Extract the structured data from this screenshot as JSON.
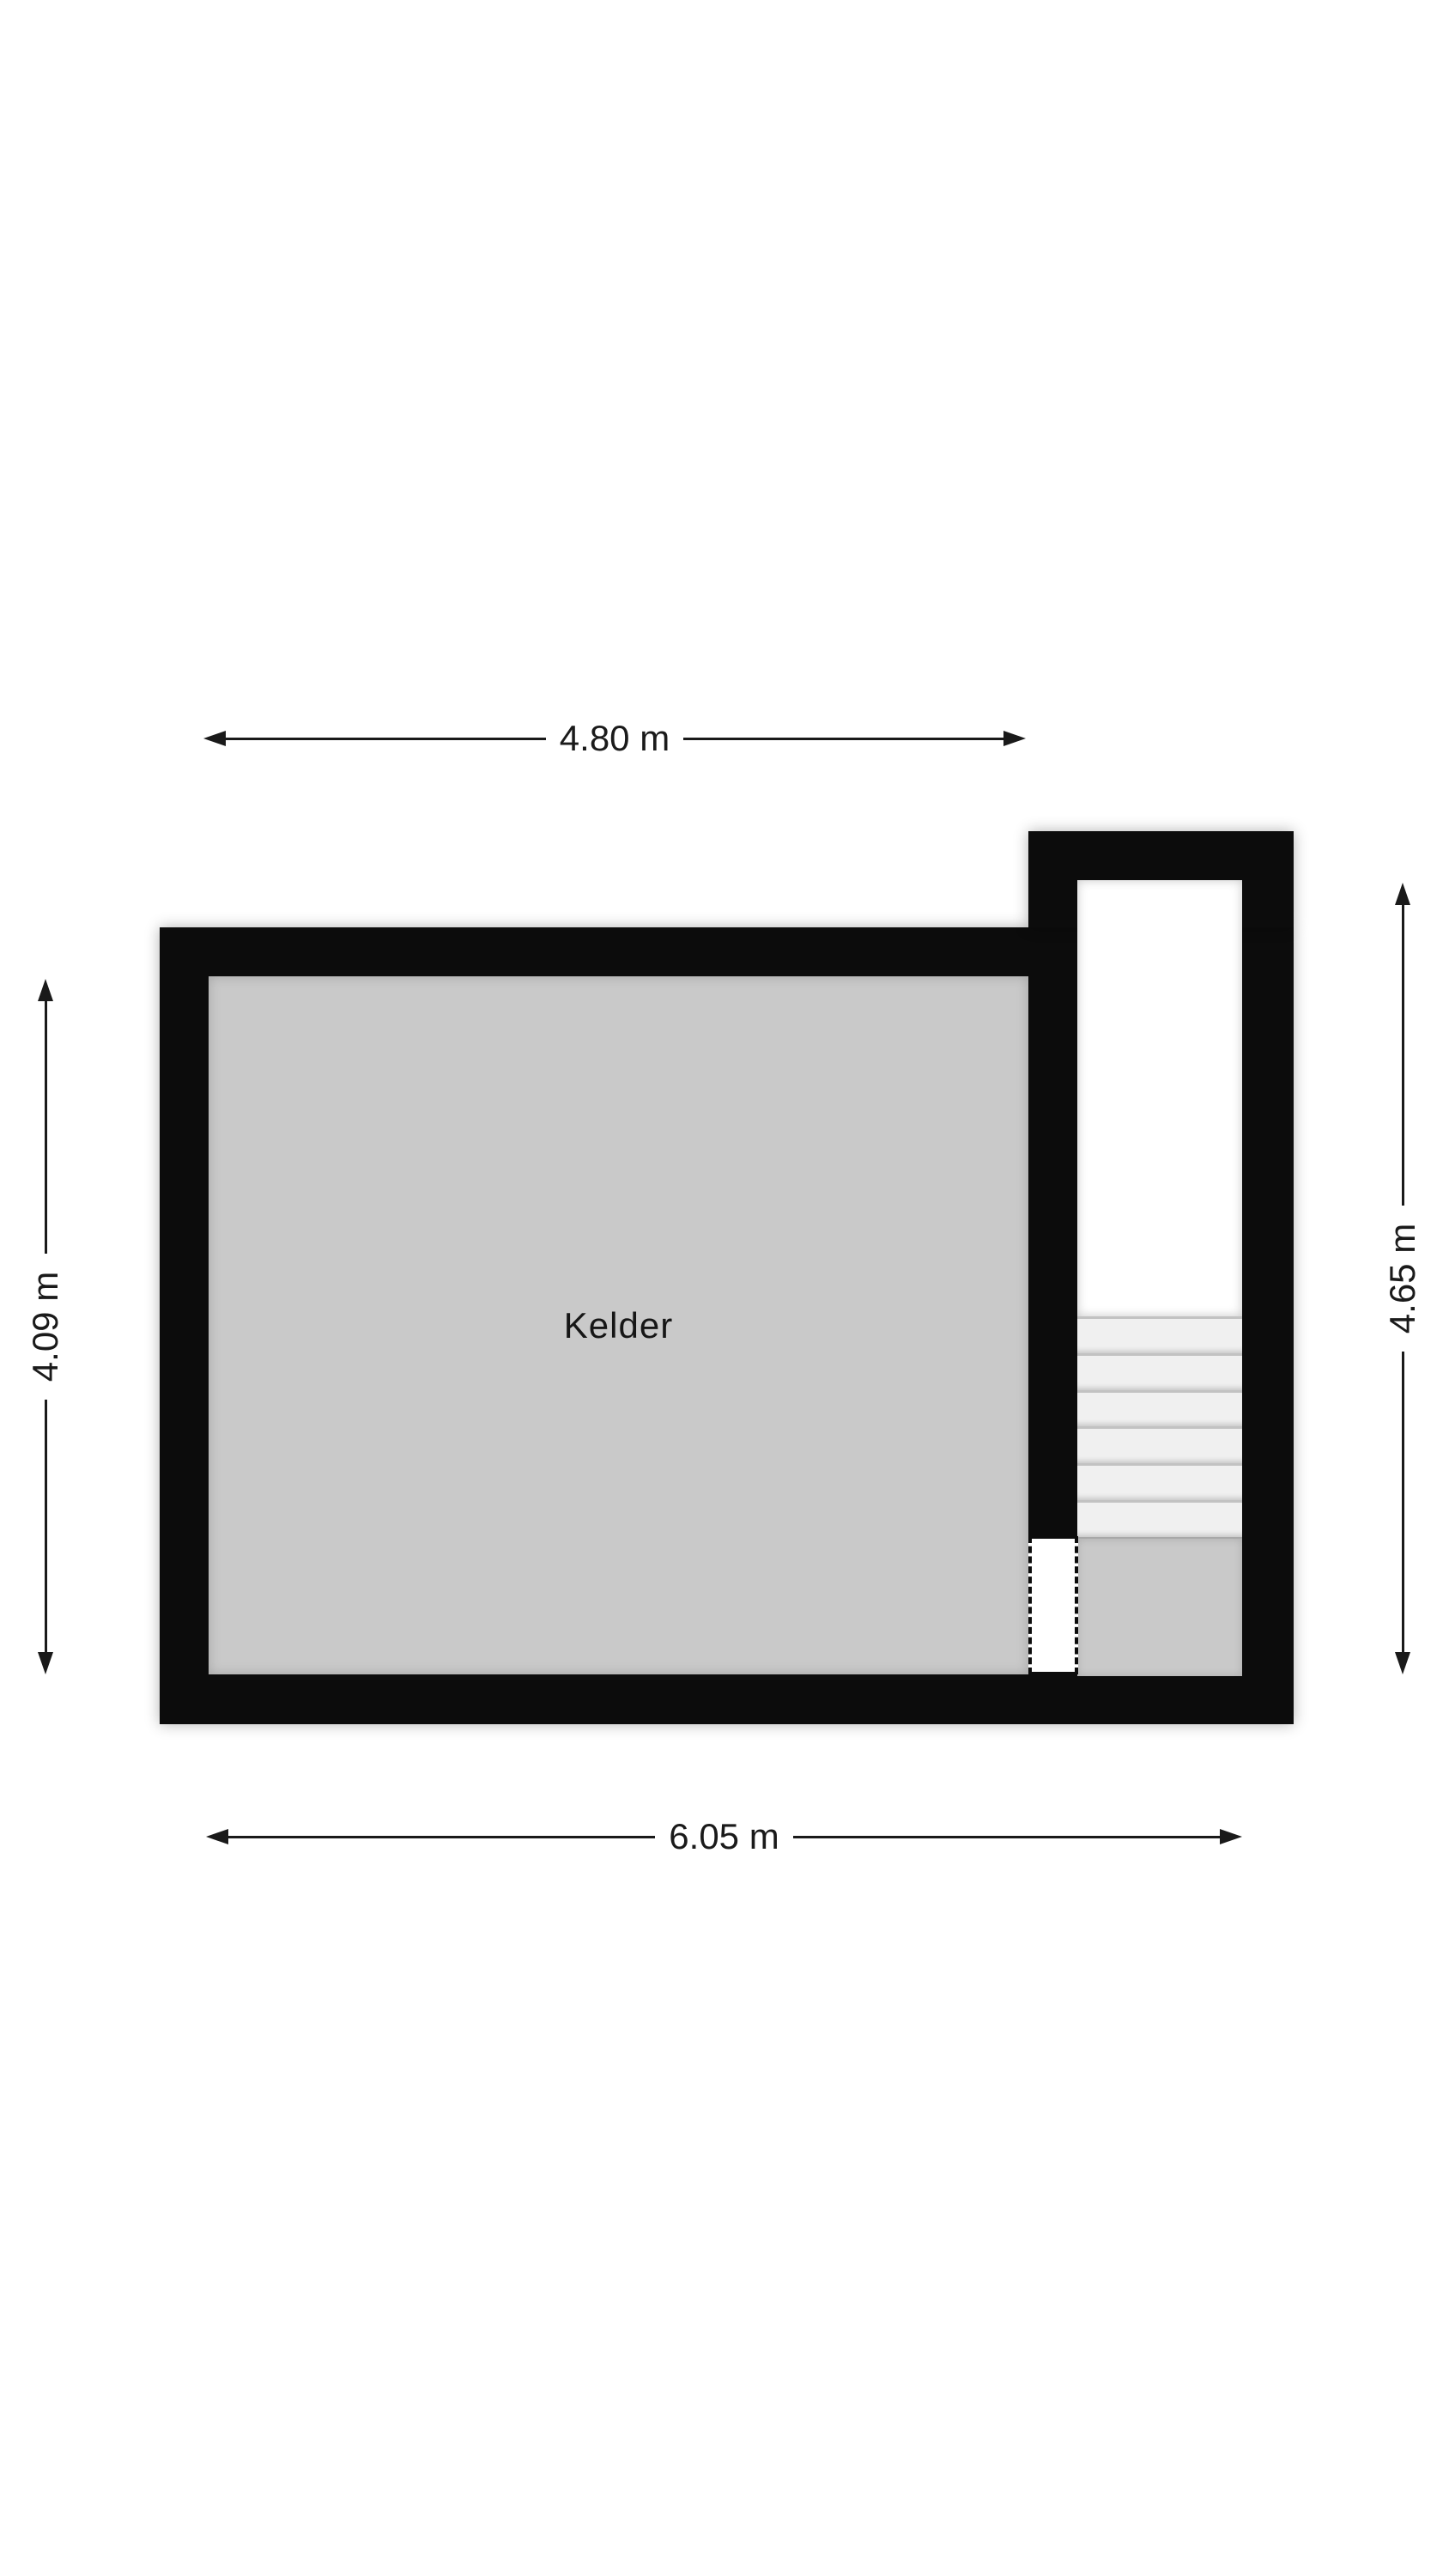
{
  "floorplan": {
    "room": {
      "label": "Kelder"
    },
    "dimensions": {
      "top": "4.80 m",
      "bottom": "6.05 m",
      "left": "4.09 m",
      "right": "4.65 m"
    },
    "stairs": {
      "tread_count": 6
    },
    "colors": {
      "page_bg": "#ffffff",
      "wall": "#0c0c0c",
      "room_fill": "#c9c9c9",
      "stair_well_fill": "#ffffff",
      "tread_fill": "#f0f0f0",
      "landing_fill": "#c9c9c9",
      "dimension_color": "#1a1a1a"
    }
  }
}
